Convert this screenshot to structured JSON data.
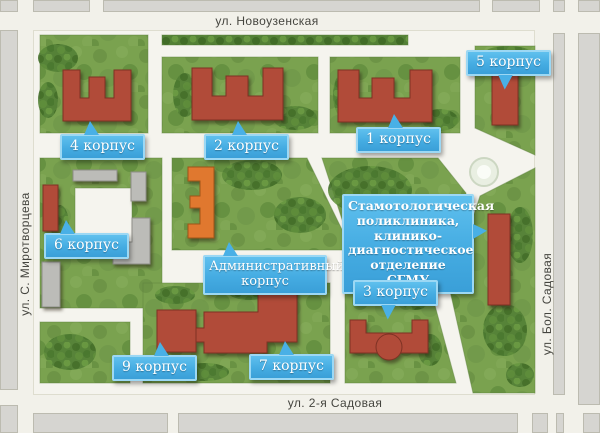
{
  "streets": {
    "top": "ул. Новоузенская",
    "bottom": "ул. 2-я Садовая",
    "left": "ул. С. Миротворцева",
    "right": "ул. Бол. Садовая"
  },
  "labels": {
    "korpus4": "4 корпус",
    "korpus2": "2 корпус",
    "korpus1": "1 корпус",
    "korpus5": "5 корпус",
    "korpus6": "6 корпус",
    "korpus3": "3 корпус",
    "korpus9": "9 корпус",
    "korpus7": "7 корпус",
    "admin": "Административный корпус",
    "stomatology": "Стамотологическая поликлиника, клинико-диагностическое отделение СГМУ"
  },
  "colors": {
    "callout_blue": "#49b0e6",
    "building_red": "#b14b39",
    "building_orange": "#e0782f",
    "building_gray": "#bcbcb8",
    "grass_green": "#7aa24f",
    "street_white": "#f5f4ee",
    "city_block_gray": "#d6d5d1"
  }
}
